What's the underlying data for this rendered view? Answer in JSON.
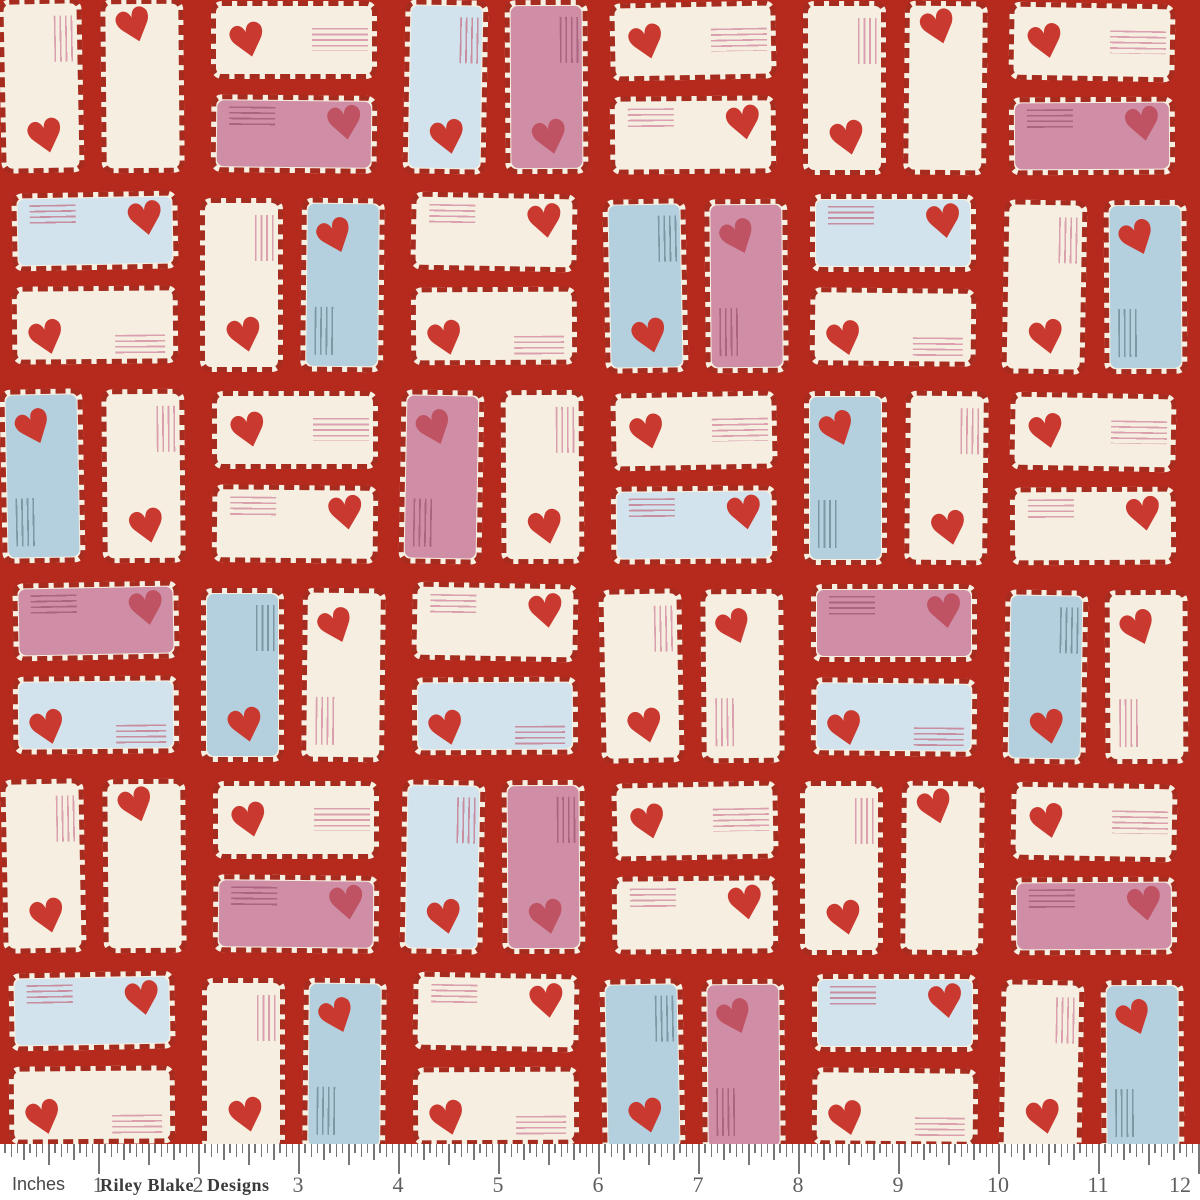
{
  "palette": {
    "background_red": "#b62a1e",
    "stripe_border_red": "#a62c1f",
    "envelope_rim": "#f6f0e3",
    "cream": "#f6efe1",
    "pink": "#cf8ea6",
    "paleblue": "#d3e3ed",
    "blue": "#b4cfdd",
    "heart_red": "#c9392f",
    "heart_on_pink": "#bf5263",
    "lines_on_cream": "#daa0ae",
    "lines_on_pink": "#aa6480",
    "lines_on_blue": "#7d97a5",
    "lines_on_paleblue": "#c68e9e",
    "ruler_bg": "#ffffff",
    "tick_gray": "#767676",
    "number_gray": "#5e5e5e",
    "brand_gray": "#3a3a3a"
  },
  "pattern": {
    "description": "love-letter envelopes with candy-stripe airmail borders, heart stamps and address lines, brick layout on red",
    "heart_glyph": "♥",
    "unit_cells": [
      [
        {
          "o": "P",
          "e": [
            {
              "c": "cream",
              "m": "pins_tr_heart_b"
            },
            {
              "c": "cream",
              "m": "heart_t"
            }
          ]
        },
        {
          "o": "L",
          "e": [
            {
              "c": "cream",
              "m": "heart_l_lines_r"
            },
            {
              "c": "pink",
              "m": "lines_tl_heart_tr"
            }
          ]
        },
        {
          "o": "P",
          "e": [
            {
              "c": "paleblue",
              "m": "pins_tr_heart_b"
            },
            {
              "c": "pink",
              "m": "pins_tr_heart_b"
            }
          ]
        },
        {
          "o": "L",
          "e": [
            {
              "c": "cream",
              "m": "heart_l_lines_r"
            },
            {
              "c": "cream",
              "m": "lines_tl_heart_tr"
            }
          ]
        }
      ],
      [
        {
          "o": "L",
          "e": [
            {
              "c": "paleblue",
              "m": "lines_tl_heart_tr"
            },
            {
              "c": "cream",
              "m": "heart_bl_lines_br"
            }
          ]
        },
        {
          "o": "P",
          "e": [
            {
              "c": "cream",
              "m": "pins_tr_heart_b"
            },
            {
              "c": "blue",
              "m": "heart_tl_pins_bl"
            }
          ]
        },
        {
          "o": "L",
          "e": [
            {
              "c": "cream",
              "m": "lines_tl_heart_tr"
            },
            {
              "c": "cream",
              "m": "heart_bl_lines_br"
            }
          ]
        },
        {
          "o": "P",
          "e": [
            {
              "c": "blue",
              "m": "pins_tr_heart_b"
            },
            {
              "c": "pink",
              "m": "heart_tl_pins_bl"
            }
          ]
        }
      ],
      [
        {
          "o": "P",
          "e": [
            {
              "c": "blue",
              "m": "heart_tl_pins_bl"
            },
            {
              "c": "cream",
              "m": "pins_tr_heart_b"
            }
          ]
        },
        {
          "o": "L",
          "e": [
            {
              "c": "cream",
              "m": "heart_l_lines_r"
            },
            {
              "c": "cream",
              "m": "lines_tl_heart_tr"
            }
          ]
        },
        {
          "o": "P",
          "e": [
            {
              "c": "pink",
              "m": "heart_tl_pins_bl"
            },
            {
              "c": "cream",
              "m": "pins_tr_heart_b"
            }
          ]
        },
        {
          "o": "L",
          "e": [
            {
              "c": "cream",
              "m": "heart_l_lines_r"
            },
            {
              "c": "paleblue",
              "m": "lines_tl_heart_tr"
            }
          ]
        }
      ],
      [
        {
          "o": "L",
          "e": [
            {
              "c": "pink",
              "m": "lines_tl_heart_tr"
            },
            {
              "c": "paleblue",
              "m": "heart_bl_lines_br"
            }
          ]
        },
        {
          "o": "P",
          "e": [
            {
              "c": "blue",
              "m": "pins_tr_heart_b"
            },
            {
              "c": "cream",
              "m": "heart_tl_pins_bl"
            }
          ]
        },
        {
          "o": "L",
          "e": [
            {
              "c": "cream",
              "m": "lines_tl_heart_tr"
            },
            {
              "c": "paleblue",
              "m": "heart_bl_lines_br"
            }
          ]
        },
        {
          "o": "P",
          "e": [
            {
              "c": "cream",
              "m": "pins_tr_heart_b"
            },
            {
              "c": "cream",
              "m": "heart_tl_pins_bl"
            }
          ]
        }
      ]
    ]
  },
  "ruler": {
    "label": "Inches",
    "brand_left": "Riley Blake",
    "brand_right": "Designs",
    "numbers": [
      "1",
      "2",
      "3",
      "4",
      "5",
      "6",
      "7",
      "8",
      "9",
      "10",
      "11",
      "12"
    ],
    "ticks_per_inch": 16
  }
}
